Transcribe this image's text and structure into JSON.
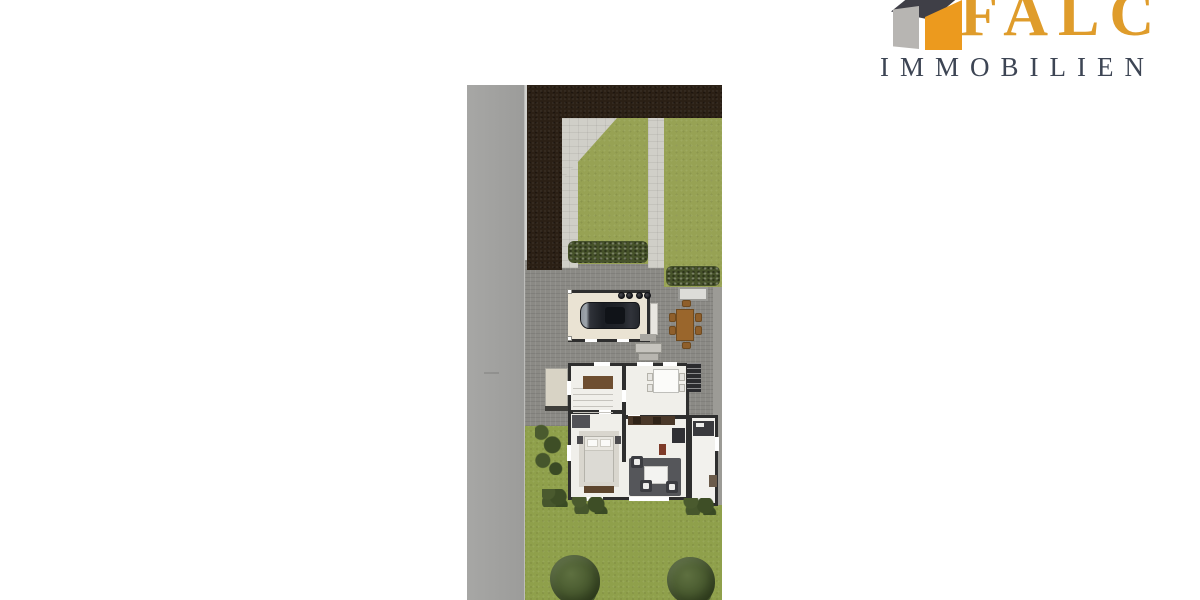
{
  "logo": {
    "brand": "FALC",
    "subtitle": "IMMOBILIEN"
  },
  "palette": {
    "road": "#A2A2A0",
    "curb": "#C6C6C2",
    "hedge": "#2B2015",
    "grass": "#97A254",
    "lawn": "#8FA04B",
    "bush": "#46522A",
    "path": "#D0CFC8",
    "path_edge": "#9C9B96",
    "cobble": "#8B8A85",
    "carport_slab": "#EAE3D3",
    "wall": "#2E2E2E",
    "floor": "#F0EFEA",
    "wood": "#9A662C",
    "wood_dark": "#6F4A1F",
    "rug": "#55565A",
    "bench": "#DCDCD8",
    "brand_orange": "#DF9C2B",
    "brand_slate": "#3D4554",
    "icon_gray": "#B7B5B2",
    "icon_dark": "#3F3F47",
    "icon_orange": "#EC9A1E"
  },
  "plan_legend": [
    "street along left side",
    "dark hedge border at top and upper left",
    "front garden lawn with light paths",
    "carport with parked car and waste bins",
    "paved cobblestone courtyard",
    "garden bench and wooden outdoor dining table",
    "house ground-floor plan with staircase hall, kitchen/dining, bedroom, living room and side annex",
    "exterior cellar stairs and entrance steps",
    "rear lawn with shrubs and two trees"
  ]
}
